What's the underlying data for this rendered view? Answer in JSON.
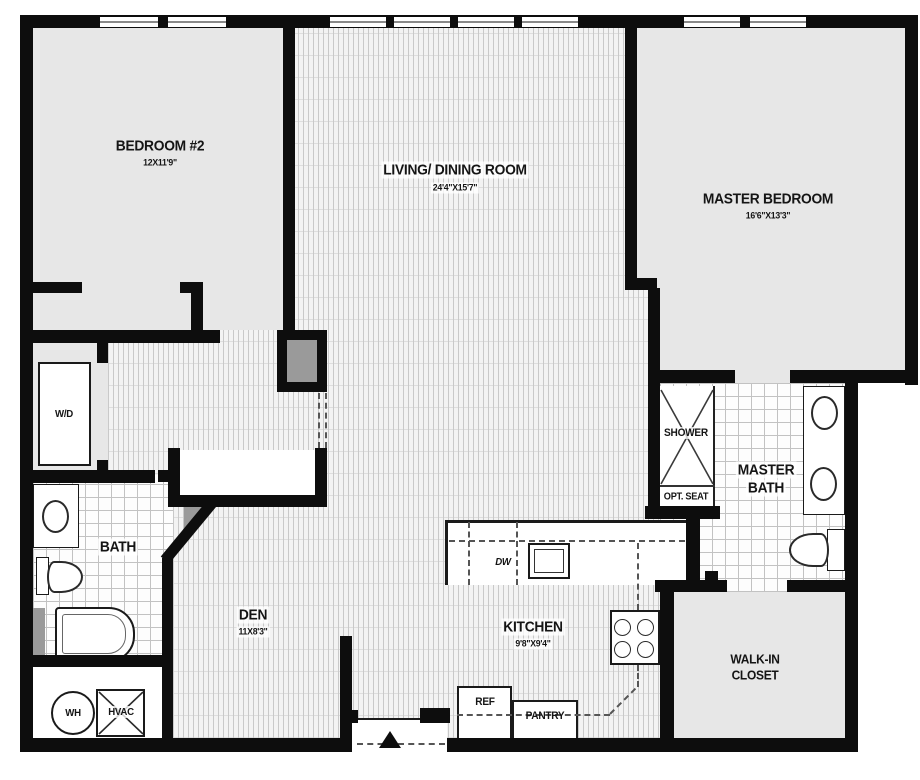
{
  "plan": {
    "title": "apartment-floor-plan",
    "rooms": {
      "bedroom2": {
        "name": "BEDROOM #2",
        "dims": "12X11'9\""
      },
      "living_dining": {
        "name": "LIVING/ DINING ROOM",
        "dims": "24'4\"X15'7\""
      },
      "master_bedroom": {
        "name": "MASTER BEDROOM",
        "dims": "16'6\"X13'3\""
      },
      "den": {
        "name": "DEN",
        "dims": "11X8'3\""
      },
      "kitchen": {
        "name": "KITCHEN",
        "dims": "9'8\"X9'4\""
      },
      "bath": {
        "name": "BATH"
      },
      "master_bath": {
        "line1": "MASTER",
        "line2": "BATH"
      },
      "walk_in_closet": {
        "line1": "WALK-IN",
        "line2": "CLOSET"
      },
      "shower": {
        "name": "SHOWER",
        "seat": "OPT. SEAT"
      },
      "laundry": {
        "name": "W/D"
      }
    },
    "appliances": {
      "dishwasher": "DW",
      "refrigerator": "REF",
      "pantry": "PANTRY",
      "water_heater": "WH",
      "hvac": "HVAC"
    },
    "colors": {
      "wall": "#0d0d0d",
      "room_fill": "#e7e7e7",
      "poche_gray": "#9a9a9a"
    }
  }
}
